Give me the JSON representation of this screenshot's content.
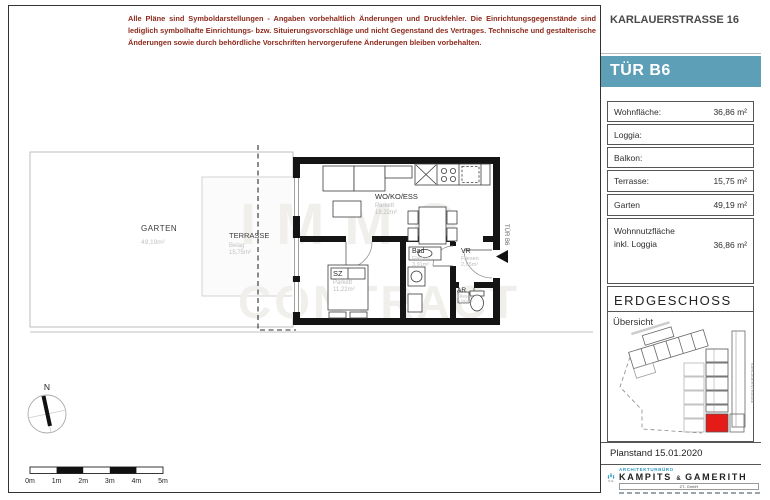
{
  "disclaimer": "Alle Pläne sind Symboldarstellungen - Angaben vorbehaltlich Änderungen und Druckfehler. Die Einrichtungsgegenstände sind lediglich symbolhafte Einrichtungs- bzw. Situierungsvorschläge und nicht Gegenstand des Vertrages. Technische und gestalterische Änderungen sowie durch behördliche Vorschriften hervorgerufene Änderungen bleiben vorbehalten.",
  "sidebar": {
    "address": "KARLAUERSTRASSE 16",
    "unit_label": "TÜR B6",
    "rows": [
      {
        "label": "Wohnfläche:",
        "value": "36,86 m²"
      },
      {
        "label": "Loggia:",
        "value": ""
      },
      {
        "label": "Balkon:",
        "value": ""
      },
      {
        "label": "Terrasse:",
        "value": "15,75 m²"
      },
      {
        "label": "Garten",
        "value": "49,19 m²"
      },
      {
        "label_line1": "Wohnnutzfläche",
        "label_line2": "inkl. Loggia",
        "value": "36,86 m²"
      }
    ],
    "floor_title": "ERDGESCHOSS",
    "overview_label": "Übersicht",
    "overview_street": "KARLAUERSTRASSE",
    "planstand": "Planstand 15.01.2020",
    "logo": {
      "bureau": "ARCHITEKTURBÜRO",
      "name1": "KAMPITS",
      "amp": "&",
      "name2": "GAMERITH",
      "sub": "ZT- GmbH"
    }
  },
  "plan": {
    "watermark_line1": "IMMO",
    "watermark_line2": "CONTRACT",
    "door_label": "TÜR B6",
    "rooms": {
      "wohnkochess": {
        "name": "WO/KO/ESS",
        "floor": "Parkett",
        "area": "18,22m²"
      },
      "sz": {
        "name": "SZ",
        "floor": "Parkett",
        "area": "11,22m²"
      },
      "bad": {
        "name": "Bad",
        "floor": "Fliesen",
        "area": "3,91m²"
      },
      "vr": {
        "name": "VR",
        "floor": "Fliesen",
        "area": "2,65m²"
      },
      "ar": {
        "name": "AR",
        "floor": "Fliesen",
        "area": "0,86m²"
      }
    },
    "outdoor": {
      "garten": {
        "name": "GARTEN",
        "area": "49,19m²"
      },
      "terrasse": {
        "name": "TERRASSE",
        "floor": "Belag",
        "area": "15,75m²"
      }
    },
    "north_label": "N",
    "scale_labels": [
      "0m",
      "1m",
      "2m",
      "3m",
      "4m",
      "5m"
    ]
  },
  "colors": {
    "accent": "#5C9FB6",
    "disclaimer_red": "#8C2A1C",
    "highlight_red": "#E41B17"
  }
}
